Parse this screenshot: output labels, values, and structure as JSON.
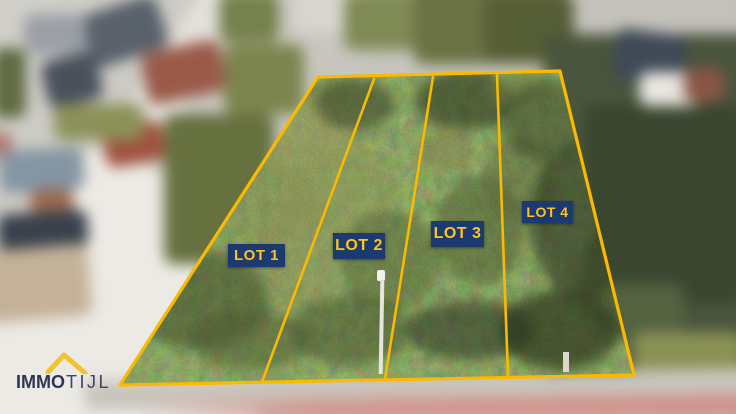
{
  "overlay": {
    "lots": [
      {
        "label": "LOT 1"
      },
      {
        "label": "LOT 2"
      },
      {
        "label": "LOT 3"
      },
      {
        "label": "LOT 4"
      }
    ]
  },
  "logo": {
    "name": "IMMOTIJL",
    "part_bold": "IMMO",
    "part_light": "TIJL",
    "icon": "house-roof-icon"
  },
  "colors": {
    "boundary_line": "#FBB900",
    "lot_label_background": "#1A3A70",
    "lot_label_text": "#FFC41F",
    "logo_text": "#2E3555",
    "logo_roof": "#F2C230"
  }
}
